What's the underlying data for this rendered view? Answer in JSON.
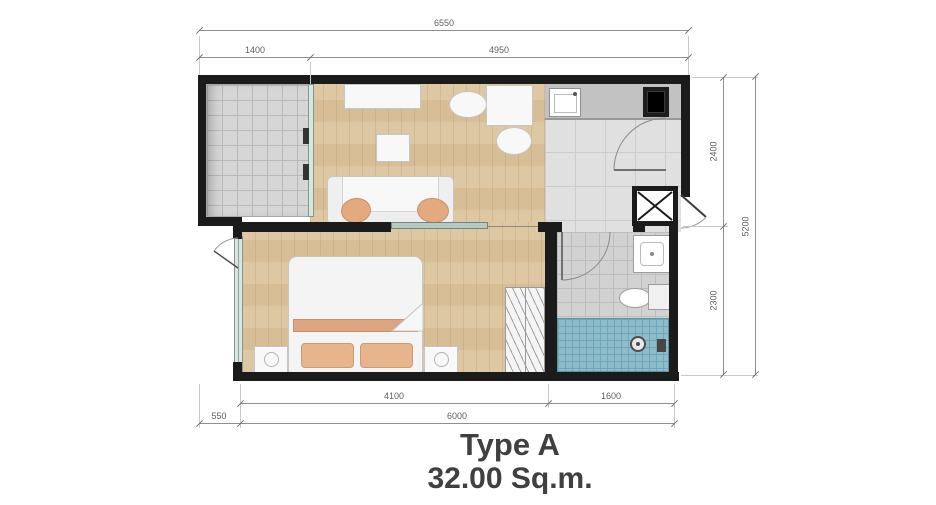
{
  "title": {
    "type": "Type A",
    "area": "32.00 Sq.m."
  },
  "dimensions": {
    "top_total": "6550",
    "top_balcony": "1400",
    "top_main": "4950",
    "right_upper": "2400",
    "right_lower": "2300",
    "right_total": "5200",
    "bottom_bedroom": "4100",
    "bottom_bathroom": "1600",
    "bottom_offset": "550",
    "bottom_total": "6000"
  },
  "rooms": {
    "balcony": {
      "name": "balcony",
      "features": [
        "tiled-floor",
        "sliding-glass-door"
      ]
    },
    "living_dining": {
      "name": "living-dining",
      "furniture": [
        "tv-console",
        "coffee-table",
        "sofa",
        "dining-table",
        "dining-chairs"
      ]
    },
    "kitchen": {
      "name": "kitchen",
      "furniture": [
        "counter",
        "sink",
        "stove"
      ]
    },
    "bedroom": {
      "name": "bedroom",
      "furniture": [
        "double-bed",
        "pillows",
        "nightstands",
        "wardrobe",
        "window"
      ]
    },
    "bathroom": {
      "name": "bathroom",
      "furniture": [
        "washbasin",
        "toilet",
        "shower"
      ]
    },
    "service": {
      "name": "shaft",
      "features": [
        "x-marked-duct",
        "entrance-door"
      ]
    }
  },
  "colors": {
    "wall": "#1b1b1b",
    "wood_floor": "#dcc39c",
    "balcony_tile": "#d6d6d6",
    "kitchen_tile": "#e0e0e0",
    "bath_tile": "#d2d2d2",
    "shower_tile": "#8fbccb",
    "accent_peach": "#e3aa80",
    "glass": "#d8e6e0",
    "dimension_text": "#5f5f5f"
  }
}
